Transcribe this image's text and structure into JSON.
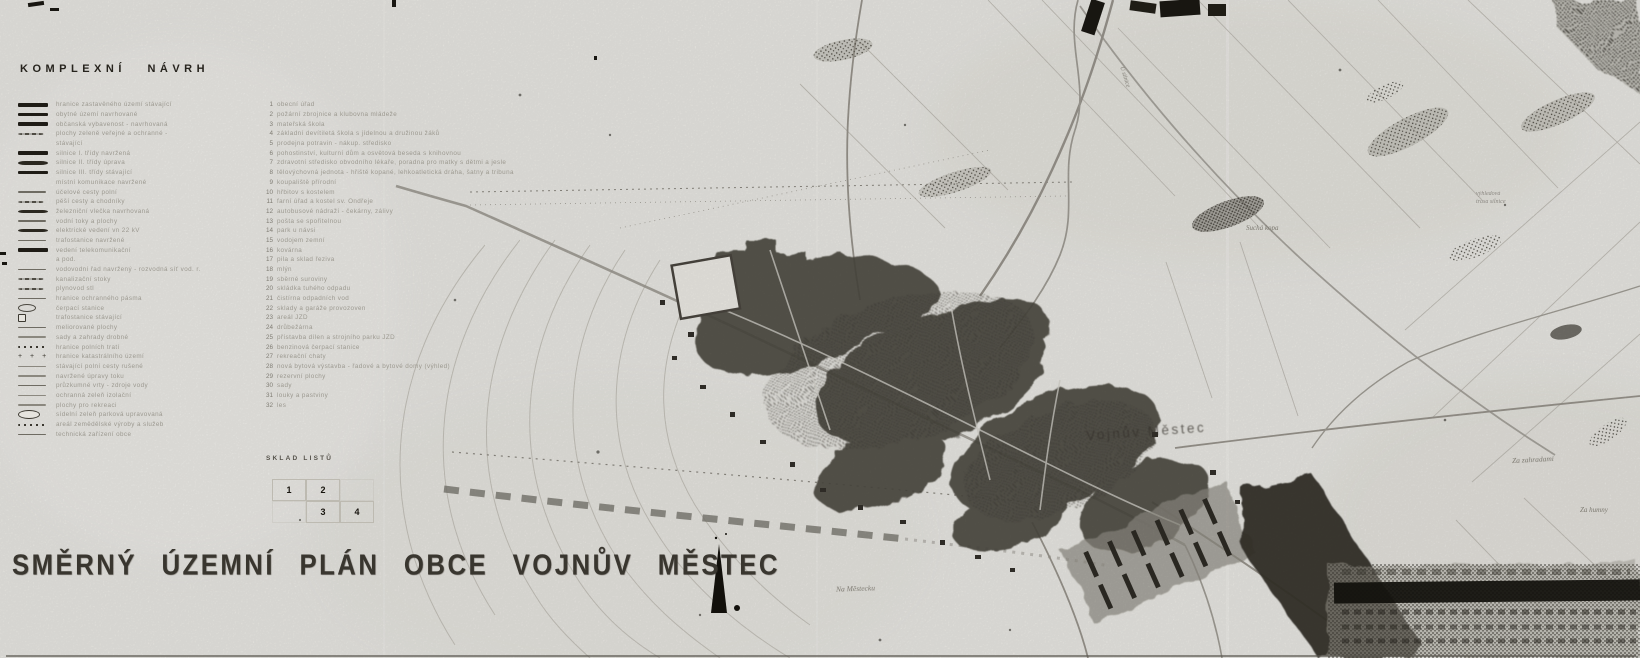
{
  "titles": {
    "section": "KOMPLEXNÍ NÁVRH",
    "main": "SMĚRNÝ ÚZEMNÍ PLÁN OBCE VOJNŮV MĚSTEC"
  },
  "legend": {
    "items": [
      {
        "symbol": "sbold",
        "text": "hranice zastavěného území stávající"
      },
      {
        "symbol": "sbold",
        "text": "obytné území navrhované"
      },
      {
        "symbol": "sbold",
        "text": "občanská vybavenost - navrhovaná"
      },
      {
        "symbol": "sscript",
        "text": "plochy zeleně veřejné a ochranné -"
      },
      {
        "symbol": "snone",
        "text": "stávající"
      },
      {
        "symbol": "sbold",
        "text": "silnice I. třídy navržená"
      },
      {
        "symbol": "sboldwavy",
        "text": "silnice II. třídy úprava"
      },
      {
        "symbol": "sbold",
        "text": "silnice III. třídy stávající"
      },
      {
        "symbol": "snone",
        "text": "místní komunikace navržené"
      },
      {
        "symbol": "sthin",
        "text": "účelové cesty polní"
      },
      {
        "symbol": "sscript",
        "text": "pěší cesty a chodníky"
      },
      {
        "symbol": "sboldwavy",
        "text": "železniční vlečka navrhovaná"
      },
      {
        "symbol": "sthin",
        "text": "vodní toky a plochy"
      },
      {
        "symbol": "sboldwavy",
        "text": "elektrické vedení vn 22 kV"
      },
      {
        "symbol": "sthin",
        "text": "trafostanice navržené"
      },
      {
        "symbol": "sbold",
        "text": "vedení telekomunikační"
      },
      {
        "symbol": "snone",
        "text": "a pod."
      },
      {
        "symbol": "sthin",
        "text": "vodovodní řad navržený - rozvodná síť  vod. r."
      },
      {
        "symbol": "sscript",
        "text": "kanalizační stoky"
      },
      {
        "symbol": "sscript",
        "text": "plynovod stl"
      },
      {
        "symbol": "sthin",
        "text": "hranice ochranného pásma"
      },
      {
        "symbol": "sellipse",
        "text": "čerpací stanice"
      },
      {
        "symbol": "ssq",
        "text": "trafostanice stávající"
      },
      {
        "symbol": "sthin",
        "text": "meliorované plochy"
      },
      {
        "symbol": "slight",
        "text": "sady a zahrady drobné"
      },
      {
        "symbol": "sdots",
        "text": "hranice polních tratí"
      },
      {
        "symbol": "scross",
        "text": "hranice katastrálního území"
      },
      {
        "symbol": "slight",
        "text": "stávající polní cesty rušené"
      },
      {
        "symbol": "slight",
        "text": "navržené úpravy toku"
      },
      {
        "symbol": "sthin",
        "text": "průzkumné vrty - zdroje vody"
      },
      {
        "symbol": "slight",
        "text": "ochranná zeleň izolační"
      },
      {
        "symbol": "slight",
        "text": "plochy pro rekreaci"
      },
      {
        "symbol": "sellipseO",
        "text": "sídelní zeleň parková upravovaná"
      },
      {
        "symbol": "sdots",
        "text": "areál zemědělské výroby a služeb"
      },
      {
        "symbol": "sthin",
        "text": "technická zařízení obce"
      }
    ]
  },
  "numbered_list": {
    "items": [
      {
        "n": "1",
        "text": "obecní úřad"
      },
      {
        "n": "2",
        "text": "požární zbrojnice a klubovna mládeže"
      },
      {
        "n": "3",
        "text": "mateřská škola"
      },
      {
        "n": "4",
        "text": "základní devítiletá škola s jídelnou a družinou žáků"
      },
      {
        "n": "5",
        "text": "prodejna potravin - nákup. středisko"
      },
      {
        "n": "6",
        "text": "pohostinství, kulturní dům a osvětová beseda s knihovnou"
      },
      {
        "n": "7",
        "text": "zdravotní středisko obvodního lékaře, poradna pro matky s dětmi a jesle"
      },
      {
        "n": "8",
        "text": "tělovýchovná jednota - hřiště kopané, lehkoatletická dráha, šatny a tribuna"
      },
      {
        "n": "9",
        "text": "koupaliště přírodní"
      },
      {
        "n": "10",
        "text": "hřbitov s kostelem"
      },
      {
        "n": "11",
        "text": "farní úřad a kostel sv. Ondřeje"
      },
      {
        "n": "12",
        "text": "autobusové nádraží - čekárny, zálivy"
      },
      {
        "n": "13",
        "text": "pošta se spořitelnou"
      },
      {
        "n": "14",
        "text": "park u návsi"
      },
      {
        "n": "15",
        "text": "vodojem zemní"
      },
      {
        "n": "16",
        "text": "kovárna"
      },
      {
        "n": "17",
        "text": "pila a sklad řeziva"
      },
      {
        "n": "18",
        "text": "mlýn"
      },
      {
        "n": "19",
        "text": "sběrné suroviny"
      },
      {
        "n": "20",
        "text": "skládka tuhého odpadu"
      },
      {
        "n": "21",
        "text": "čistírna odpadních vod"
      },
      {
        "n": "22",
        "text": "sklady a garáže provozoven"
      },
      {
        "n": "23",
        "text": "areál JZD"
      },
      {
        "n": "24",
        "text": "drůbežárna"
      },
      {
        "n": "25",
        "text": "přístavba dílen a strojního parku JZD"
      },
      {
        "n": "26",
        "text": "benzinová čerpací stanice"
      },
      {
        "n": "27",
        "text": "rekreační chaty"
      },
      {
        "n": "28",
        "text": "nová bytová výstavba - řadové a bytové domy (výhled)"
      },
      {
        "n": "29",
        "text": "rezervní plochy"
      },
      {
        "n": "30",
        "text": "sady"
      },
      {
        "n": "31",
        "text": "louky a pastviny"
      },
      {
        "n": "32",
        "text": "les"
      }
    ]
  },
  "sheet_index": {
    "label": "SKLAD LISTŮ",
    "rows": [
      [
        "1",
        "2",
        ""
      ],
      [
        "",
        "3",
        "4"
      ]
    ]
  },
  "map_labels": {
    "town": "Vojnův Městec",
    "hill_ne": "Suchá kopa",
    "note_line1": "výhledová",
    "note_line2": "trasa silnice",
    "field_e": "Za zahradami",
    "field_s": "Na Městecku",
    "field_se": "Za humny",
    "road": "U silnice"
  },
  "colors": {
    "paper": "#ecebe6",
    "ink": "#1f1c16",
    "town_fill": "#4c4840",
    "light_line": "#c3c0b8"
  }
}
